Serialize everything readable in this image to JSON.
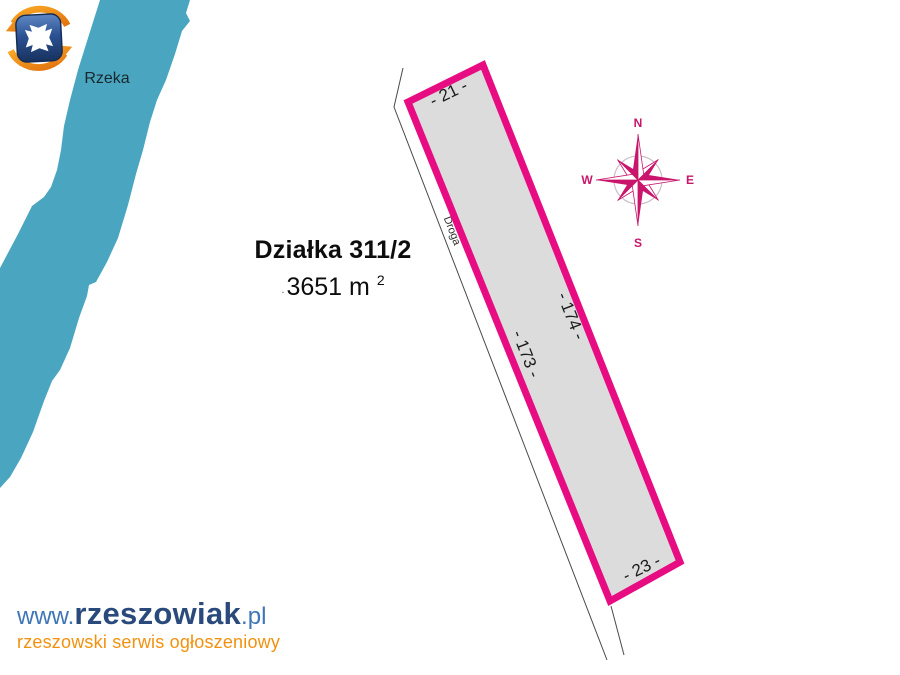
{
  "page": {
    "background": "#ffffff"
  },
  "river": {
    "label": "Rzeka",
    "color": "#4AA6C0"
  },
  "parcel": {
    "title": "Działka 311/2",
    "area_dot": ".",
    "area_value": "3651 m",
    "area_exponent": "2",
    "fill": "#DCDCDC",
    "border_color": "#E80C82",
    "dimensions": {
      "top": "- 21 -",
      "right": "- 174 -",
      "left": "- 173 -",
      "bottom": "- 23 -"
    }
  },
  "road": {
    "label": "Droga"
  },
  "compass": {
    "color": "#C9156B",
    "n": "N",
    "e": "E",
    "s": "S",
    "w": "W"
  },
  "footer_logo": {
    "www": "www.",
    "name": "rzeszowiak",
    "tld": ".pl",
    "tagline": "rzeszowski serwis ogłoszeniowy",
    "name_color": "#294A7B",
    "accent_color": "#3E76B6",
    "tagline_color": "#F2910E"
  },
  "brand_icon": {
    "name": "rzeszowiak-emblem",
    "shield_color": "#1D3C72",
    "arrow_color": "#F28C1C"
  }
}
